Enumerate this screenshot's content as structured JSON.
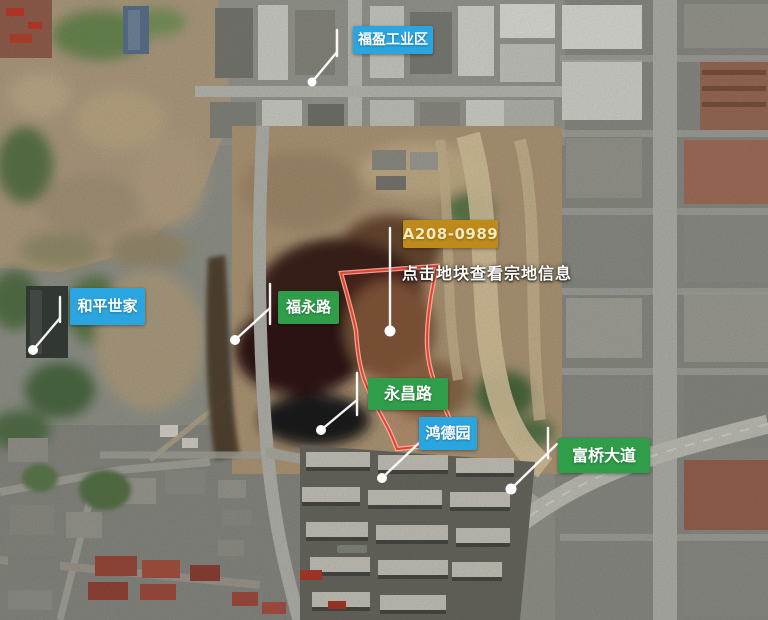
{
  "map": {
    "view_type": "satellite",
    "parcel": {
      "id": "A208-0989",
      "hint": "点击地块查看宗地信息",
      "outline_color": "#e8402a",
      "label_bg_color": "#bd8a1b",
      "label_text_color": "#f6e9bd"
    },
    "markers": [
      {
        "name": "fuying-industrial-zone",
        "text": "福盈工业区",
        "kind": "place",
        "color": "#2aa5df"
      },
      {
        "name": "heping-shijia",
        "text": "和平世家",
        "kind": "place",
        "color": "#2aa5df"
      },
      {
        "name": "fuyong-road",
        "text": "福永路",
        "kind": "road",
        "color": "#2f9d49"
      },
      {
        "name": "yongchang-road",
        "text": "永昌路",
        "kind": "road",
        "color": "#2f9d49"
      },
      {
        "name": "hongde-garden",
        "text": "鸿德园",
        "kind": "place",
        "color": "#2aa5df"
      },
      {
        "name": "fuqiao-avenue",
        "text": "富桥大道",
        "kind": "road",
        "color": "#2f9d49"
      }
    ],
    "colors": {
      "place_marker_bg": "#2aa5df",
      "road_marker_bg": "#2f9d49",
      "marker_text": "#ffffff",
      "leader_line": "#ffffff"
    }
  }
}
